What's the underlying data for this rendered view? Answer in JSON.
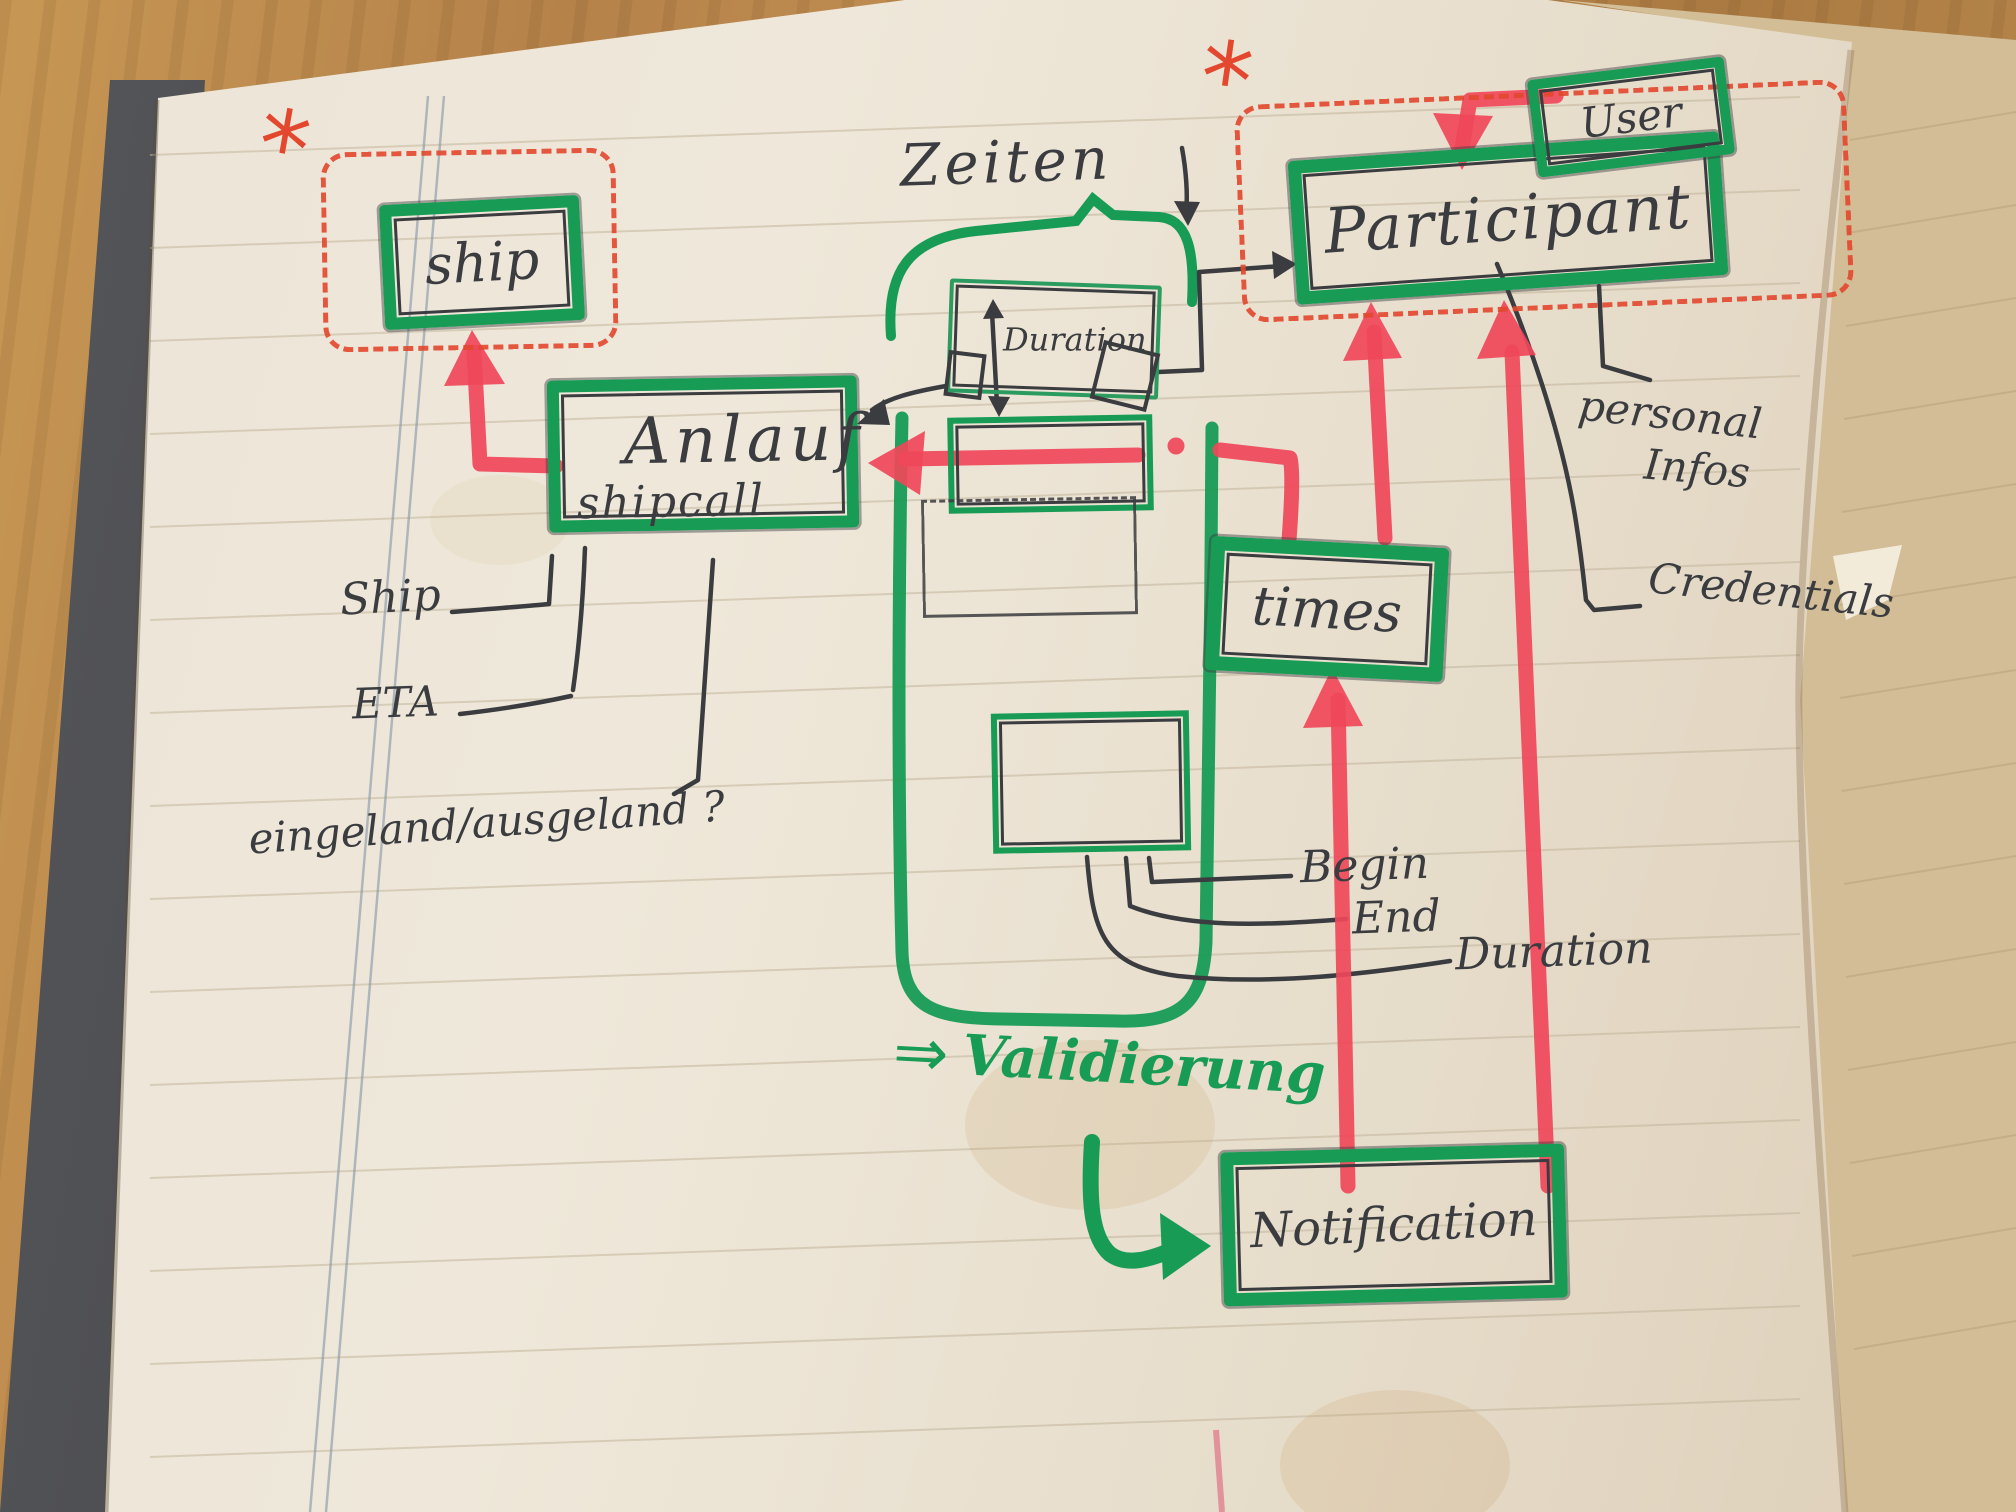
{
  "annotations": {
    "zeiten": "Zeiten",
    "validierung_arrow": "⇒",
    "validierung": "Validierung",
    "asterisk_left": "*",
    "asterisk_right": "*"
  },
  "nodes": {
    "ship": "ship",
    "anlauf": "Anlauf",
    "anlauf_sub": "shipcall",
    "duration": "Duration",
    "participant": "Participant",
    "user": "User",
    "times": "times",
    "notification": "Notification"
  },
  "attributes": {
    "ship": "Ship",
    "eta": "ETA",
    "in_out": "eingeland/ausgeland ?",
    "personal_line1": "personal",
    "personal_line2": "Infos",
    "credentials": "Credentials",
    "begin": "Begin",
    "end": "End",
    "duration": "Duration"
  },
  "colors": {
    "green_marker": "#179b55",
    "red_marker": "#f0485a",
    "red_pen": "#e3472e",
    "ink": "#3b3c40"
  }
}
